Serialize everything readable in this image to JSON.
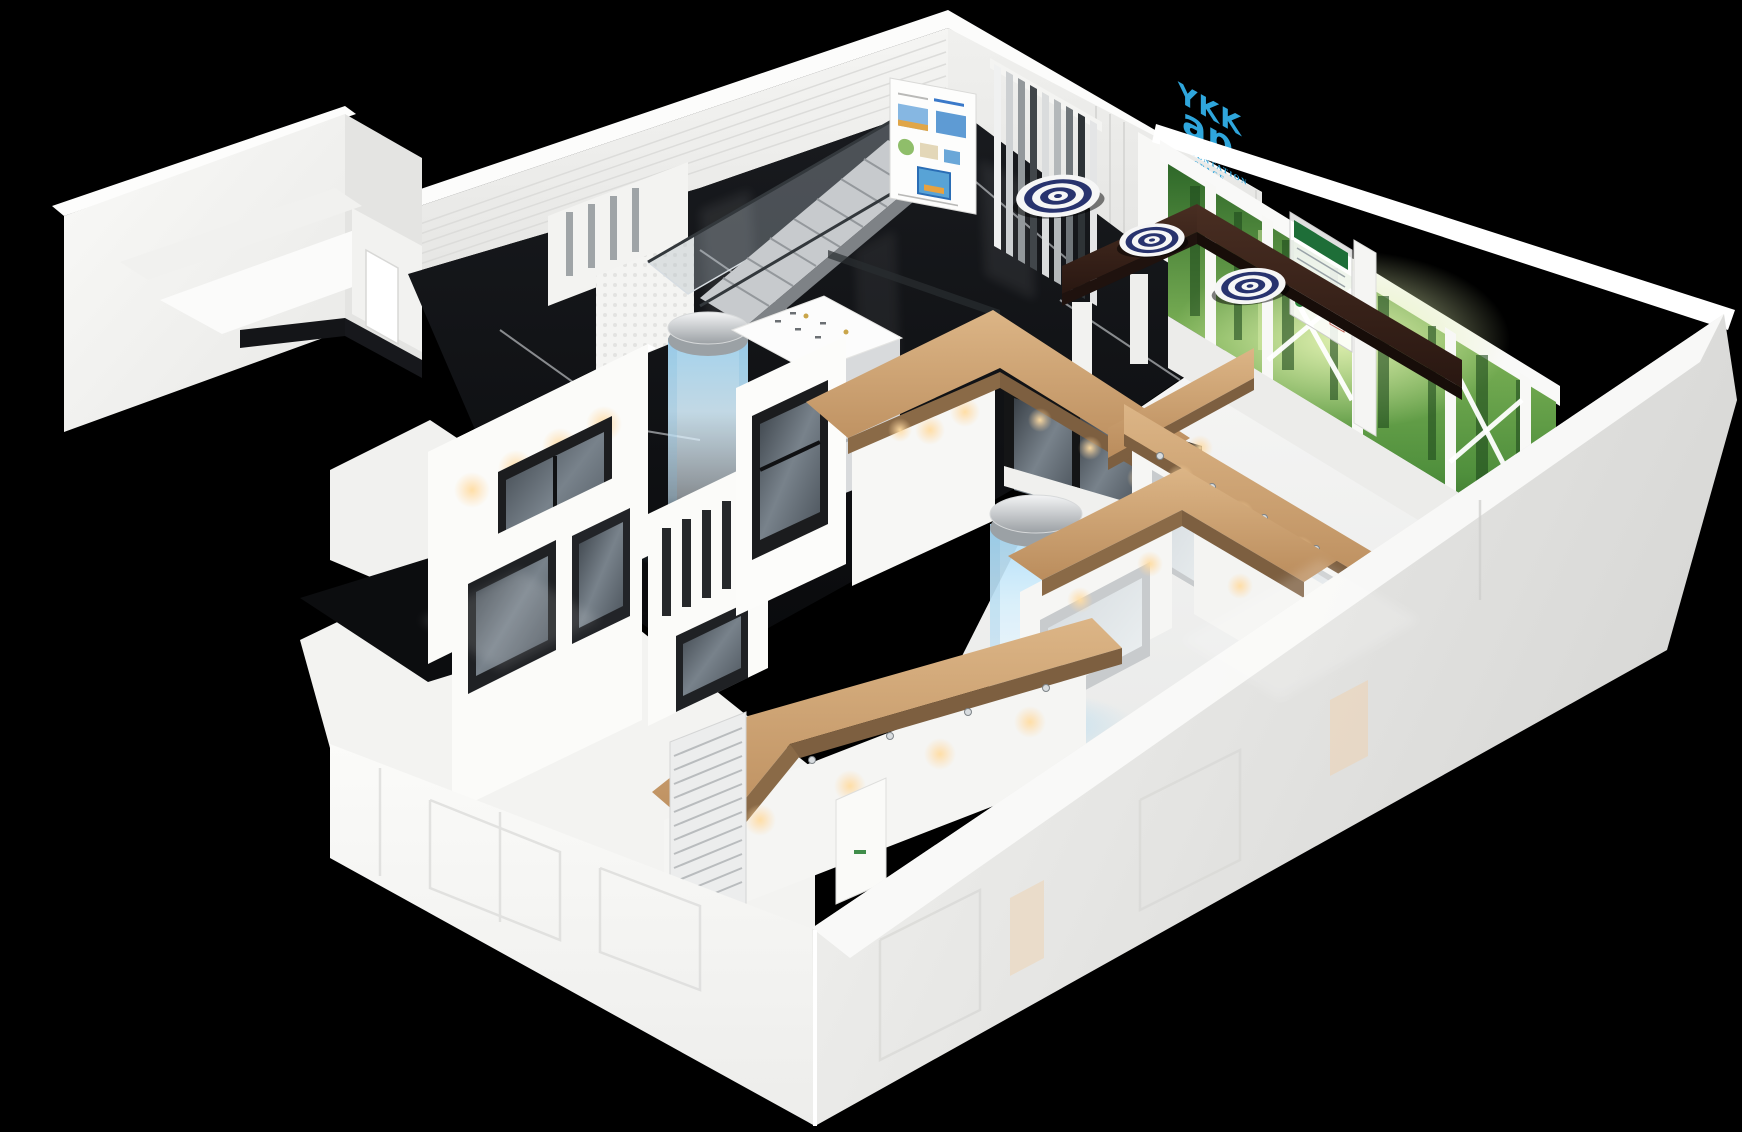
{
  "window": {
    "width": 1742,
    "height": 1132,
    "background": "#000000"
  },
  "logo": {
    "brand_top": "YKK",
    "brand_bottom": "ap",
    "registered": "®",
    "subtitle_line1": "PRESENTATION",
    "subtitle_line2": "SPACE",
    "subtitle_line3": "TAIPEI",
    "color": "#2fa6dc"
  },
  "palette": {
    "background": "#000000",
    "wall_white": "#f4f4f2",
    "floor_marble_black": "#101114",
    "floor_gloss_white": "#f3f4f3",
    "wood_light": "#c79a69",
    "wood_dark_wenge": "#33201a",
    "cylinder_glow_blue": "#b5e0f8",
    "spotlight_warm": "#ffd9a2",
    "forest_green": "#57963f",
    "ottoman_navy": "#28336e",
    "glass_gray": "#5a626a",
    "louver_dark": "#3a3f43"
  }
}
